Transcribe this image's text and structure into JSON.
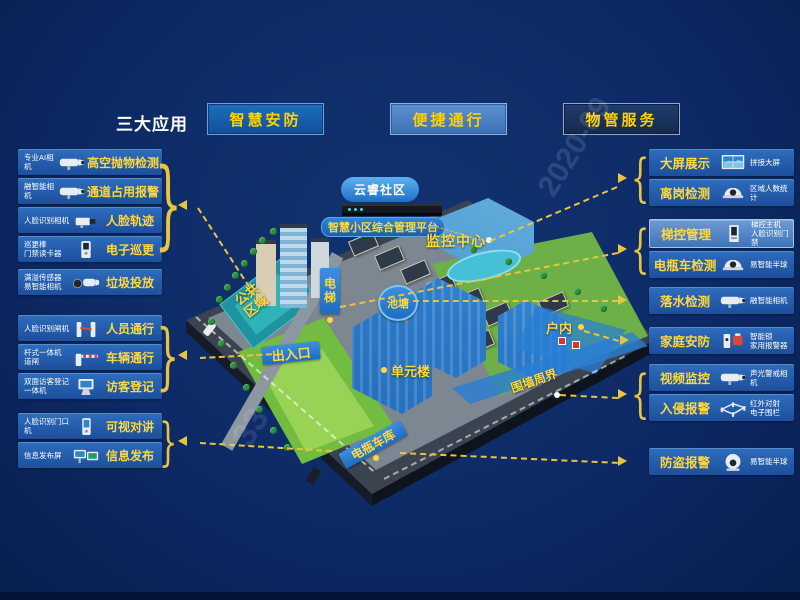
{
  "colors": {
    "background": "#0d2a66",
    "panel_blue": "#2a69b8",
    "highlight_blue": "#4d82c4",
    "accent_yellow": "#ffd83a",
    "connector_yellow": "#e9c43d",
    "button_text": "#ffd200"
  },
  "header": {
    "title": "三大应用",
    "buttons": [
      {
        "label": "智慧安防"
      },
      {
        "label": "便捷通行"
      },
      {
        "label": "物管服务"
      }
    ]
  },
  "left_panel": {
    "groups": [
      {
        "items": [
          {
            "device_lines": [
              "专业AI相机"
            ],
            "label": "高空抛物检测",
            "icon": "bullet-camera"
          },
          {
            "device_lines": [
              "融智能相机"
            ],
            "label": "通道占用报警",
            "icon": "bullet-camera"
          },
          {
            "device_lines": [
              "人脸识别相机"
            ],
            "label": "人脸轨迹",
            "icon": "box-camera"
          },
          {
            "device_lines": [
              "巡更棒",
              "门禁读卡器"
            ],
            "label": "电子巡更",
            "icon": "card-reader"
          },
          {
            "device_lines": [
              "满溢传感器",
              "易智能相机"
            ],
            "label": "垃圾投放",
            "icon": "sensor-camera"
          }
        ]
      },
      {
        "items": [
          {
            "device_lines": [
              "人脸识别闸机"
            ],
            "label": "人员通行",
            "icon": "turnstile"
          },
          {
            "device_lines": [
              "杆式一体机",
              "道闸"
            ],
            "label": "车辆通行",
            "icon": "barrier-gate"
          },
          {
            "device_lines": [
              "双面访客登记",
              "一体机"
            ],
            "label": "访客登记",
            "icon": "visitor-kiosk"
          }
        ]
      },
      {
        "items": [
          {
            "device_lines": [
              "人脸识别门口机"
            ],
            "label": "可视对讲",
            "icon": "door-station"
          },
          {
            "device_lines": [
              "信息发布屏"
            ],
            "label": "信息发布",
            "icon": "info-screen"
          }
        ]
      }
    ]
  },
  "right_panel": {
    "groups": [
      {
        "items": [
          {
            "label": "大屏展示",
            "device_lines": [
              "拼接大屏"
            ],
            "icon": "video-wall"
          },
          {
            "label": "离岗检测",
            "device_lines": [
              "区域人数统计"
            ],
            "icon": "dome-camera"
          }
        ]
      },
      {
        "items": [
          {
            "label": "梯控管理",
            "device_lines": [
              "梯控主机",
              "人脸识别门禁"
            ],
            "icon": "elevator-terminal",
            "highlighted": true
          },
          {
            "label": "电瓶车检测",
            "device_lines": [
              "易智能半球"
            ],
            "icon": "dome-camera"
          }
        ]
      },
      {
        "items": [
          {
            "label": "落水检测",
            "device_lines": [
              "融智能相机"
            ],
            "icon": "bullet-camera"
          }
        ]
      },
      {
        "items": [
          {
            "label": "家庭安防",
            "device_lines": [
              "智能锁",
              "家用报警器"
            ],
            "icon": "lock-alarm"
          }
        ]
      },
      {
        "items": [
          {
            "label": "视频监控",
            "device_lines": [
              "声光警戒相机"
            ],
            "icon": "bullet-camera"
          },
          {
            "label": "入侵报警",
            "device_lines": [
              "红外对射",
              "电子围栏"
            ],
            "icon": "fence"
          }
        ]
      },
      {
        "items": [
          {
            "label": "防盗报警",
            "device_lines": [
              "易智能半球"
            ],
            "icon": "turret-camera"
          }
        ]
      }
    ]
  },
  "map": {
    "cloud": "云睿社区",
    "platform": "智慧小区综合管理平台",
    "monitor_center": "监控中心",
    "elevator": "电梯",
    "pond": "池塘",
    "public_area": "公共区域",
    "entrance": "出入口",
    "unit_building": "单元楼",
    "indoor": "户内",
    "perimeter": "围墙周界",
    "bike_garage": "电瓶车库"
  },
  "watermarks": [
    "2020-09",
    "33"
  ]
}
